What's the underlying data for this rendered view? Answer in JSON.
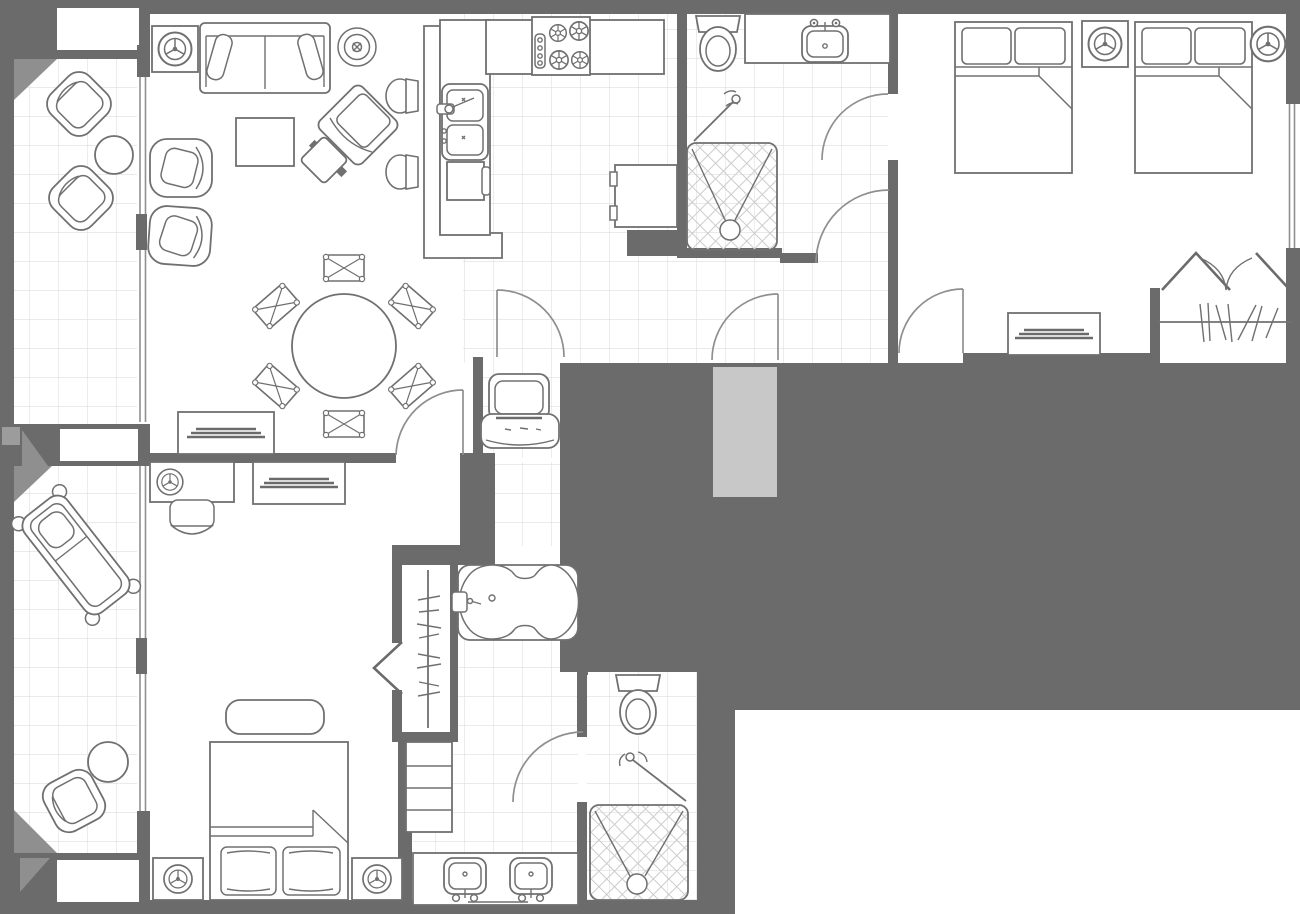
{
  "title": "Two-bedroom suite floor plan",
  "colors": {
    "wall": "#6b6b6b",
    "outline": "#707070",
    "tile_line": "#dedede",
    "hatch_line": "#cccccc",
    "bevel": "#8f8f8f",
    "entry_mat": "#c8c8c8",
    "background": "#ffffff"
  },
  "rooms": [
    {
      "name": "balcony-upper",
      "floor": "tile",
      "items": [
        "lounge-chair",
        "lounge-chair",
        "round-side-table"
      ]
    },
    {
      "name": "living-room",
      "floor": "carpet",
      "items": [
        "ceiling-fan",
        "sofa",
        "ceiling-light",
        "coffee-table",
        "accent-chair",
        "accent-chair",
        "angled-armchair",
        "ottoman",
        "bar-stool",
        "bar-stool",
        "bar-counter",
        "dining-table-round",
        "dining-chair",
        "dining-chair",
        "dining-chair",
        "dining-chair",
        "dining-chair",
        "dining-chair",
        "credenza"
      ]
    },
    {
      "name": "kitchen",
      "floor": "tile",
      "items": [
        "cooktop-4-burner",
        "double-sink",
        "dishwasher",
        "counter",
        "refrigerator"
      ]
    },
    {
      "name": "bathroom-upper",
      "floor": "tile",
      "items": [
        "toilet",
        "vanity-sink",
        "mirror",
        "shower-enclosure",
        "shower-glass-door"
      ]
    },
    {
      "name": "bedroom-upper-right",
      "floor": "carpet",
      "items": [
        "double-bed",
        "double-bed",
        "nightstand-ceiling-fan",
        "ceiling-fan",
        "dresser",
        "closet-bifold",
        "clothes-rod",
        "window"
      ]
    },
    {
      "name": "entry-hall",
      "floor": "tile",
      "items": [
        "entry-door",
        "entry-mat",
        "luggage-bench"
      ]
    },
    {
      "name": "balcony-lower",
      "floor": "tile",
      "items": [
        "chaise-lounge",
        "round-side-table",
        "lounge-chair"
      ]
    },
    {
      "name": "bedroom-lower-left",
      "floor": "carpet",
      "items": [
        "desk",
        "desk-fan",
        "desk-chair",
        "dresser",
        "king-bed",
        "bench",
        "nightstand-ceiling-fan",
        "nightstand-ceiling-fan",
        "closet-bifold",
        "clothes-rod",
        "wardrobe-shelves"
      ]
    },
    {
      "name": "bathroom-lower",
      "floor": "tile",
      "items": [
        "garden-tub",
        "double-vanity",
        "sink",
        "sink",
        "toilet",
        "shower-enclosure",
        "shower-glass-door",
        "closet-rod"
      ]
    }
  ],
  "counts": {
    "doors_swing": 7,
    "glass_doors": 2,
    "showers": 2,
    "toilets": 2,
    "sinks": 5,
    "beds": 3,
    "ceiling_fans": 6
  }
}
